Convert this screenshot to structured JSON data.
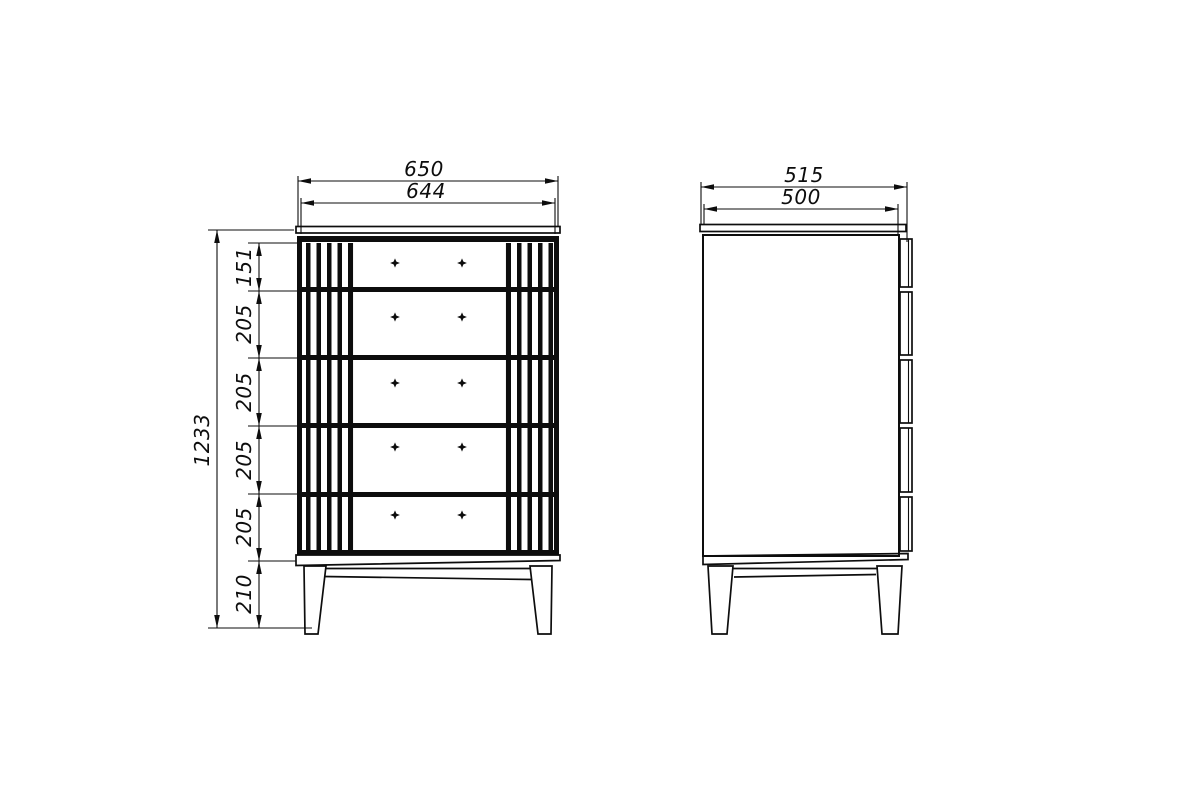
{
  "drawing": {
    "background_color": "#ffffff",
    "line_color": "#0d0d0d",
    "front_view": {
      "dim_width_overall": "650",
      "dim_width_carcass": "644",
      "dim_height_overall": "1233",
      "dim_segments": [
        "151",
        "205",
        "205",
        "205",
        "205",
        "210"
      ]
    },
    "side_view": {
      "dim_depth_overall": "515",
      "dim_depth_carcass": "500"
    }
  }
}
